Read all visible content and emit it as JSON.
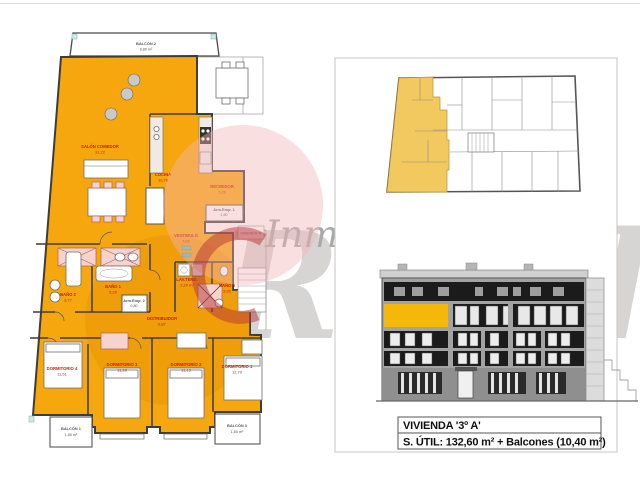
{
  "info_box": {
    "line1": "VIVIENDA '3º A'",
    "line2": "S. ÚTIL: 132,60 m² + Balcones (10,40 m²)"
  },
  "watermark": {
    "brand_top": "Inmobiliaria",
    "brand_main": "Ronda"
  },
  "floor_plan": {
    "unit_door_label": "VIVIENDA 'A'",
    "rooms": [
      {
        "label": "SALÓN COMEDOR",
        "area": "31,22"
      },
      {
        "label": "COCINA",
        "area": "10,78"
      },
      {
        "label": "RECIBIDOR",
        "area": "7,29"
      },
      {
        "label": "Arm.Emp. 1",
        "area": "1,60"
      },
      {
        "label": "VESTIBULO",
        "area": "7,02"
      },
      {
        "label": "LAV.TEND.",
        "area": "2,20 m²"
      },
      {
        "label": "BAÑO 1",
        "area": "5,29"
      },
      {
        "label": "BAÑO 2",
        "area": "3,77"
      },
      {
        "label": "BAÑO 3",
        "area": "3,92"
      },
      {
        "label": "Arm.Emp. 2",
        "area": "0,80"
      },
      {
        "label": "DISTRIBUIDOR",
        "area": "6,87"
      },
      {
        "label": "DORMITORIO 1",
        "area": "12,70"
      },
      {
        "label": "DORMITORIO 2",
        "area": "11,13"
      },
      {
        "label": "DORMITORIO 3",
        "area": "11,28"
      },
      {
        "label": "DORMITORIO 4",
        "area": "11,51"
      }
    ],
    "balconies": [
      {
        "label": "BALCÓN 1",
        "area": "1,80 m²"
      },
      {
        "label": "BALCÓN 2",
        "area": "6,80 m²"
      },
      {
        "label": "BALCÓN 3",
        "area": "1,80 m²"
      }
    ]
  },
  "colors": {
    "plan_orange": "#f6a70d",
    "plan_orange_shade": "#df8400",
    "site_plan_yellow": "#f2c95f",
    "elevation_yellow": "#f5b80a",
    "elevation_dark": "#1b1b1b",
    "label_red": "#c41f10",
    "logo_pink": "#f3b3b6",
    "logo_red": "#b53538"
  }
}
